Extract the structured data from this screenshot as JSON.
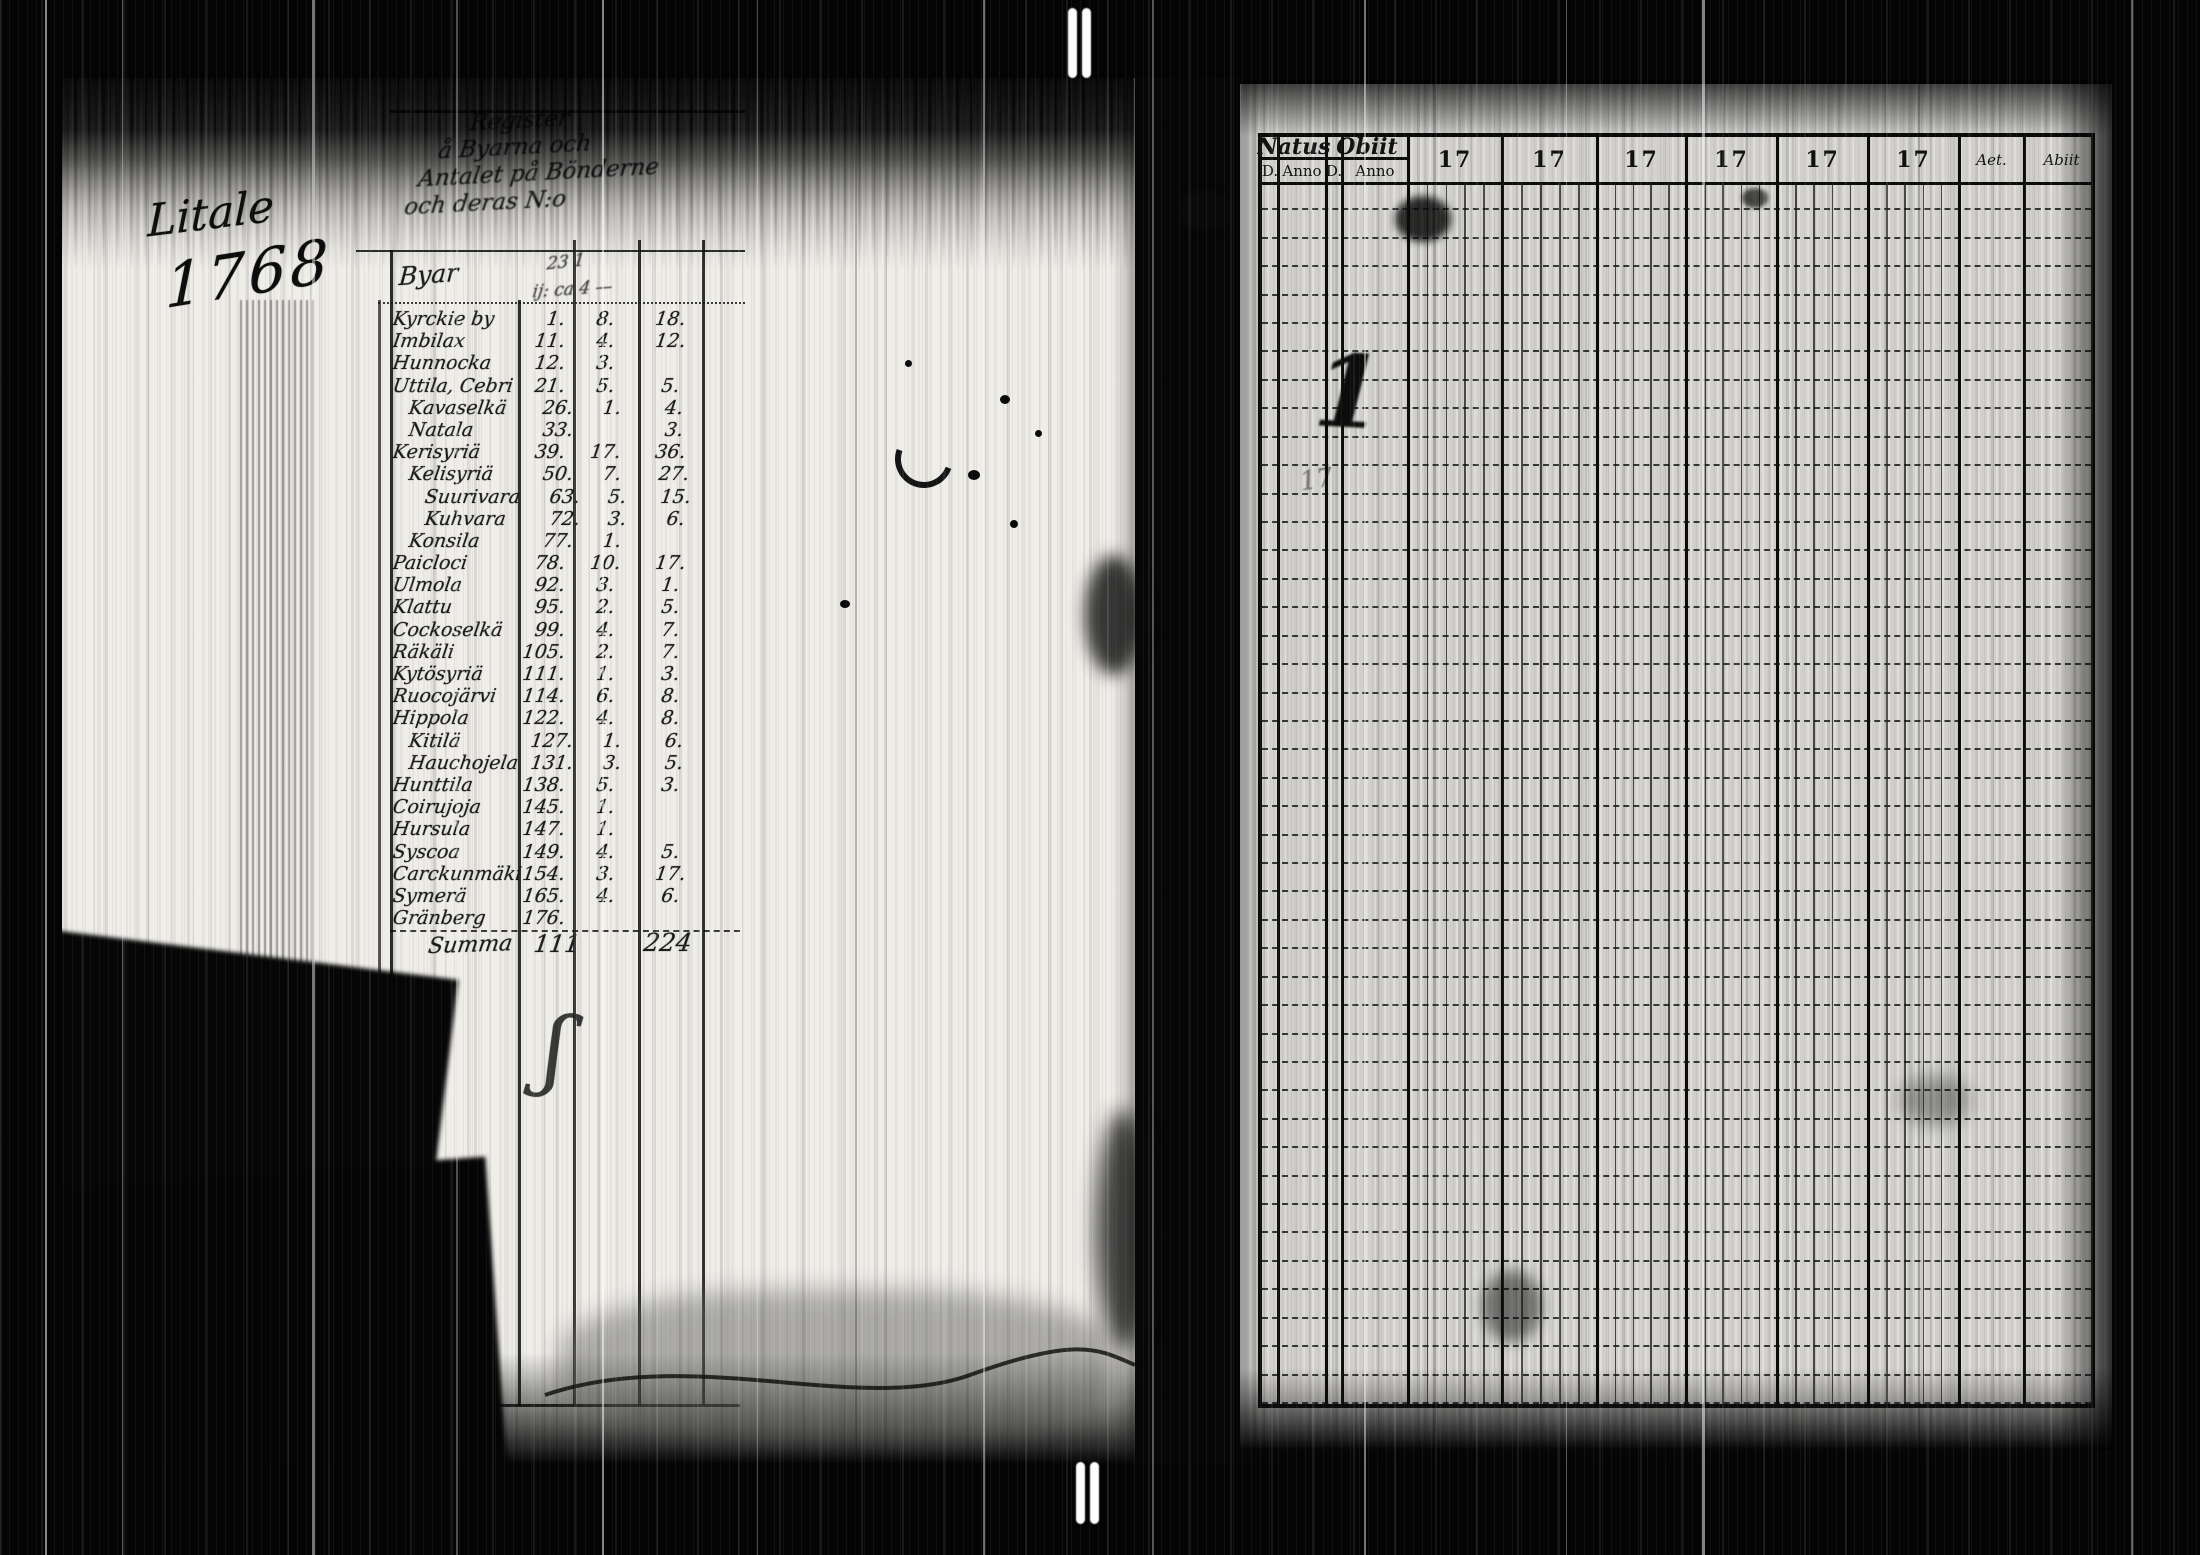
{
  "scan": {
    "margin_note": "Litale",
    "year_note": "1768",
    "flourish_mark": "ʃ"
  },
  "left_page": {
    "title_lines": [
      "Register",
      "å Byarna och",
      "Antalet på Bönderne",
      "och deras N:o"
    ],
    "byar_label": "Byar",
    "header_marks": [
      "23 1",
      "ij: ca 4 —"
    ],
    "rows": [
      {
        "name": "Kyrckie by",
        "no": "1.",
        "c2": "8.",
        "c3": "18.",
        "indent": 0
      },
      {
        "name": "Imbilax",
        "no": "11.",
        "c2": "4.",
        "c3": "12.",
        "indent": 0
      },
      {
        "name": "Hunnocka",
        "no": "12.",
        "c2": "3.",
        "c3": "",
        "indent": 0
      },
      {
        "name": "Uttila, Cebri",
        "no": "21.",
        "c2": "5.",
        "c3": "5.",
        "indent": 0
      },
      {
        "name": "Kavaselkä",
        "no": "26.",
        "c2": "1.",
        "c3": "4.",
        "indent": 1
      },
      {
        "name": "Natala",
        "no": "33.",
        "c2": "",
        "c3": "3.",
        "indent": 1
      },
      {
        "name": "Kerisyriä",
        "no": "39.",
        "c2": "17.",
        "c3": "36.",
        "indent": 0
      },
      {
        "name": "Kelisyriä",
        "no": "50.",
        "c2": "7.",
        "c3": "27.",
        "indent": 1
      },
      {
        "name": "Suurivara",
        "no": "63.",
        "c2": "5.",
        "c3": "15.",
        "indent": 2
      },
      {
        "name": "Kuhvara",
        "no": "72.",
        "c2": "3.",
        "c3": "6.",
        "indent": 2
      },
      {
        "name": "Konsila",
        "no": "77.",
        "c2": "1.",
        "c3": "",
        "indent": 1
      },
      {
        "name": "Paicloci",
        "no": "78.",
        "c2": "10.",
        "c3": "17.",
        "indent": 0
      },
      {
        "name": "Ulmola",
        "no": "92.",
        "c2": "3.",
        "c3": "1.",
        "indent": 0
      },
      {
        "name": "Klattu",
        "no": "95.",
        "c2": "2.",
        "c3": "5.",
        "indent": 0
      },
      {
        "name": "Cockoselkä",
        "no": "99.",
        "c2": "4.",
        "c3": "7.",
        "indent": 0
      },
      {
        "name": "Räkäli",
        "no": "105.",
        "c2": "2.",
        "c3": "7.",
        "indent": 0
      },
      {
        "name": "Kytösyriä",
        "no": "111.",
        "c2": "1.",
        "c3": "3.",
        "indent": 0
      },
      {
        "name": "Ruocojärvi",
        "no": "114.",
        "c2": "6.",
        "c3": "8.",
        "indent": 0
      },
      {
        "name": "Hippola",
        "no": "122.",
        "c2": "4.",
        "c3": "8.",
        "indent": 0
      },
      {
        "name": "Kitilä",
        "no": "127.",
        "c2": "1.",
        "c3": "6.",
        "indent": 1
      },
      {
        "name": "Hauchojela",
        "no": "131.",
        "c2": "3.",
        "c3": "5.",
        "indent": 1
      },
      {
        "name": "Hunttila",
        "no": "138.",
        "c2": "5.",
        "c3": "3.",
        "indent": 0
      },
      {
        "name": "Coirujoja",
        "no": "145.",
        "c2": "1.",
        "c3": "",
        "indent": 0
      },
      {
        "name": "Hursula",
        "no": "147.",
        "c2": "1.",
        "c3": "",
        "indent": 0
      },
      {
        "name": "Syscoa",
        "no": "149.",
        "c2": "4.",
        "c3": "5.",
        "indent": 0
      },
      {
        "name": "Carckunmäki",
        "no": "154.",
        "c2": "3.",
        "c3": "17.",
        "indent": 0
      },
      {
        "name": "Symerä",
        "no": "165.",
        "c2": "4.",
        "c3": "6.",
        "indent": 0
      },
      {
        "name": "Gränberg",
        "no": "176.",
        "c2": "",
        "c3": "",
        "indent": 0
      }
    ],
    "summa_label": "Summa",
    "summa_total_1": "111",
    "summa_total_2": "224"
  },
  "right_page": {
    "natus_label": "Natus",
    "obiit_label": "Obiit",
    "sub_day_label": "D.",
    "sub_anno_label": "Anno",
    "year_cols": [
      "17",
      "17",
      "17",
      "17",
      "17",
      "17"
    ],
    "aetas_label": "Aet.",
    "abiit_label": "Abiit",
    "row_count": 43,
    "ink_mark_1": "1",
    "ink_mark_2": "17"
  }
}
